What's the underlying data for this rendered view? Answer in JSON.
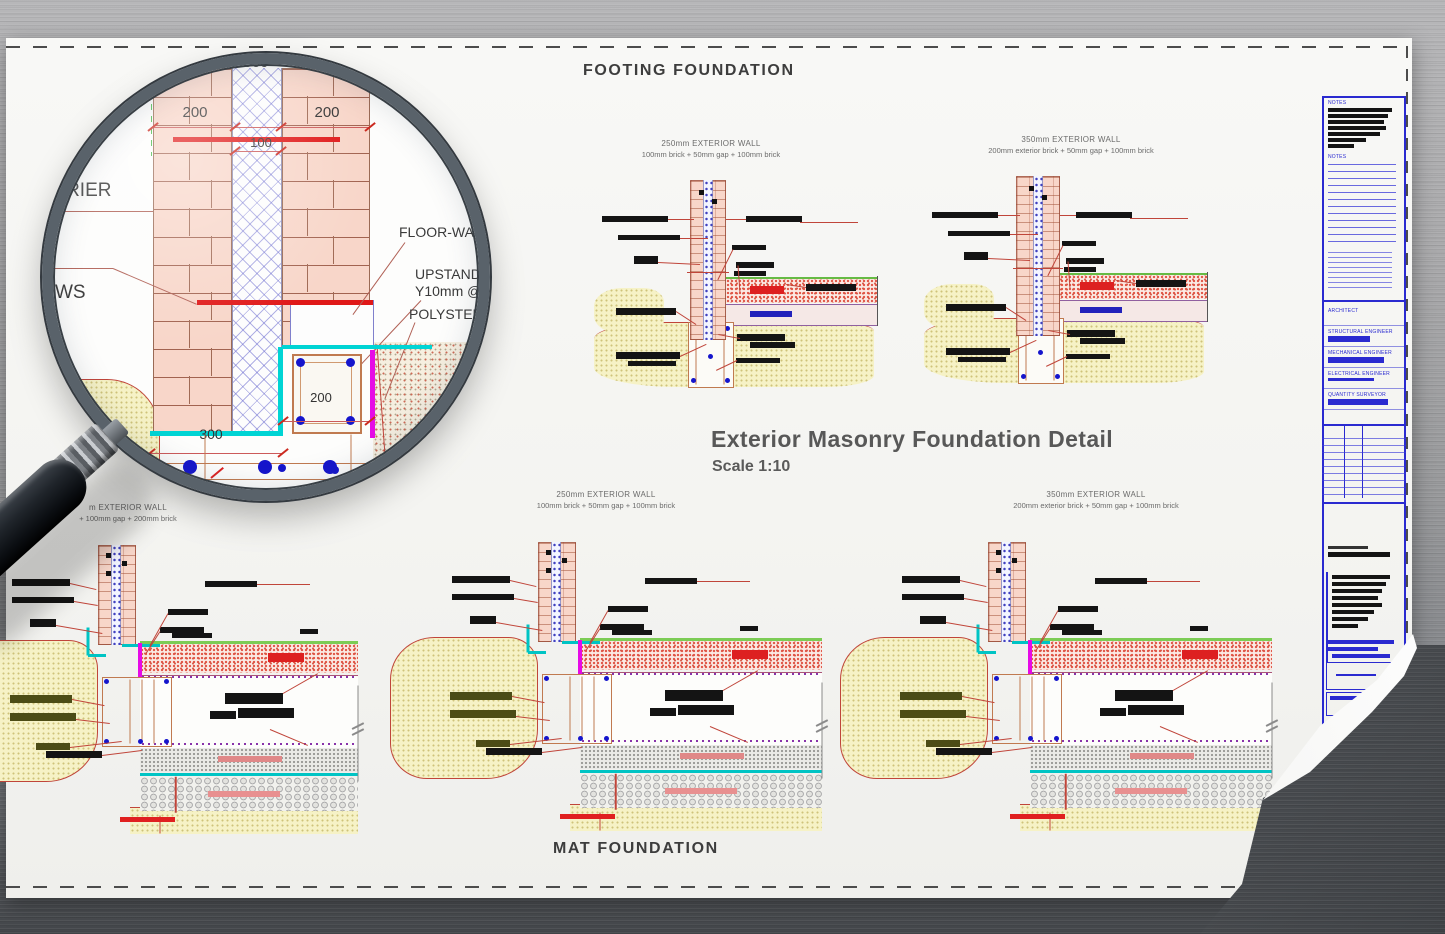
{
  "sheet": {
    "top_title": "FOOTING FOUNDATION",
    "bottom_title": "MAT FOUNDATION",
    "heading": "Exterior Masonry Foundation Detail",
    "subheading": "Scale 1:10"
  },
  "footing_details": [
    {
      "title": "250mm EXTERIOR WALL",
      "subtitle": "100mm brick + 50mm gap + 100mm brick"
    },
    {
      "title": "350mm EXTERIOR WALL",
      "subtitle": "200mm exterior brick + 50mm gap + 100mm brick"
    }
  ],
  "mat_details": [
    {
      "title": "m EXTERIOR WALL",
      "subtitle": "+ 100mm gap + 200mm brick"
    },
    {
      "title": "250mm EXTERIOR WALL",
      "subtitle": "100mm brick + 50mm gap + 100mm brick"
    },
    {
      "title": "350mm EXTERIOR WALL",
      "subtitle": "200mm exterior brick + 50mm gap + 100mm brick"
    }
  ],
  "magnifier": {
    "dims": {
      "overall": "500",
      "left_leaf": "200",
      "right_leaf": "200",
      "cavity": "100",
      "upstand_width": "200",
      "footing_width": "300"
    },
    "labels": {
      "barrier": "BARRIER",
      "ws": "WS",
      "floor_wall": "FLOOR-WA",
      "upstand": "UPSTAND",
      "upstand_bar": "Y10mm @",
      "polystyrene": "POLYSTER"
    }
  },
  "title_block": {
    "notes_top": "NOTES",
    "notes_bottom": "NOTES",
    "roles": [
      "ARCHITECT",
      "STRUCTURAL ENGINEER",
      "MECHANICAL ENGINEER",
      "ELECTRICAL ENGINEER",
      "QUANTITY SURVEYOR"
    ]
  },
  "colors": {
    "brick": "#f8d6c9",
    "dim_red": "#cc2a20",
    "cyan": "#00d4d4",
    "magenta": "#e60be6",
    "rebar_blue": "#1515cc",
    "ground_yellow": "#f6f2c6",
    "title_block_blue": "#2a2ad0"
  }
}
